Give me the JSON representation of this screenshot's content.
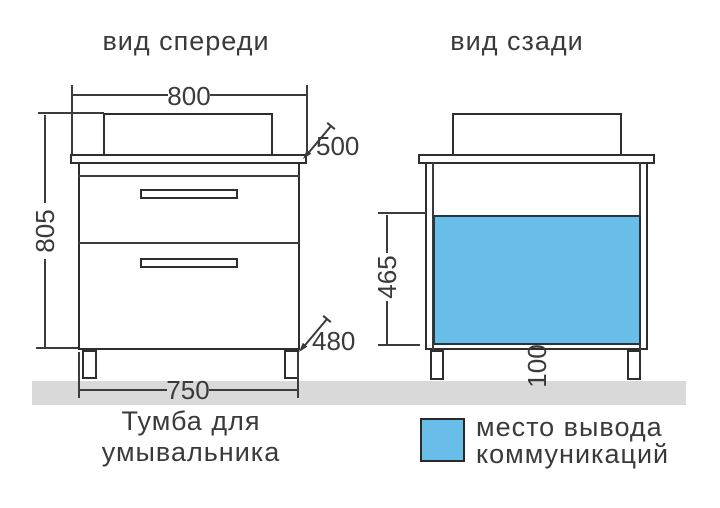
{
  "front_view": {
    "title": "вид спереди",
    "dim_width_top": "800",
    "dim_height": "805",
    "dim_depth_top": "500",
    "dim_width_bottom": "750",
    "dim_depth_bottom": "480",
    "caption_line1": "Тумба для",
    "caption_line2": "умывальника"
  },
  "back_view": {
    "title": "вид сзади",
    "dim_panel_height": "465",
    "dim_leg_height": "100"
  },
  "legend": {
    "label_line1": "место вывода",
    "label_line2": "коммуникаций"
  },
  "colors": {
    "accent_blue": "#69bde9",
    "outline": "#2e2e2e",
    "floor_gray": "#d9d9d9",
    "text": "#3a3a3a"
  }
}
